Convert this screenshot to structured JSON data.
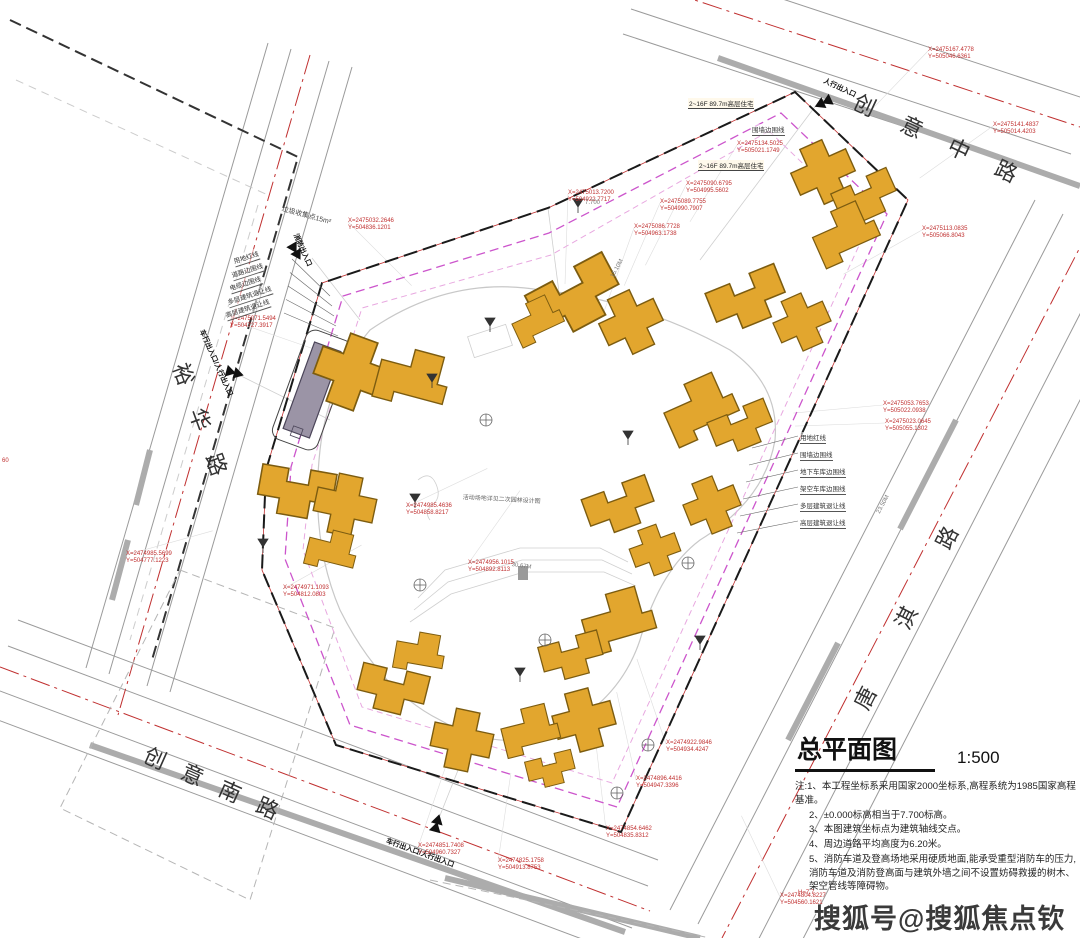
{
  "watermark": "搜狐号@搜狐焦点钦州站",
  "title_block": {
    "title": "总平面图",
    "scale": "1:500",
    "notes_label": "注:",
    "notes": [
      "1、本工程坐标系采用国家2000坐标系,高程系统为1985国家高程基准。",
      "2、±0.000标高相当于7.700标高。",
      "3、本图建筑坐标点为建筑轴线交点。",
      "4、周边道路平均高度为6.20米。",
      "5、消防车道及登高场地采用硬质地面,能承受重型消防车的压力,消防车道及消防登高面与建筑外墙之间不设置妨碍救援的树木、架空管线等障碍物。"
    ]
  },
  "roads": [
    {
      "name": "创意中路"
    },
    {
      "name": "裕华路"
    },
    {
      "name": "创意南路"
    },
    {
      "name": "唐淇路"
    }
  ],
  "entrances": [
    {
      "label": "人行出入口"
    },
    {
      "label": "消防出入口"
    },
    {
      "label": "车行出入口/人行出入口"
    },
    {
      "label": "车行出入口/人行出入口"
    }
  ],
  "callouts_left": [
    "用地红线",
    "道路边围线",
    "电缆边围线",
    "多层建筑退让线",
    "高层建筑退让线"
  ],
  "callouts_right": [
    "用地红线",
    "围墙边围线",
    "地下车库边围线",
    "架空车库边围线",
    "多层建筑退让线",
    "高层建筑退让线"
  ],
  "annotations": {
    "garbage_point": "垃圾收集点15m²",
    "highrise_tag": "2~16F 89.7m高层住宅",
    "fence_tag": "围墙边围线",
    "center_note": "活动场地详见二次园林设计图",
    "left_edge_mark": "60",
    "elev_mark": "H=7.7",
    "dim_labels": [
      "15.10M",
      "30.67M",
      "23.50M",
      "7.700"
    ]
  },
  "coordinates": [
    {
      "x": "X=2475032.2646",
      "y": "Y=504836.1201"
    },
    {
      "x": "X=2475013.7200",
      "y": "Y=504922.7717"
    },
    {
      "x": "X=2475086.7728",
      "y": "Y=504963.1738"
    },
    {
      "x": "X=2475089.7755",
      "y": "Y=504990.7907"
    },
    {
      "x": "X=2475090.6795",
      "y": "Y=504995.5602"
    },
    {
      "x": "X=2475134.5025",
      "y": "Y=505021.1749"
    },
    {
      "x": "X=2475167.4778",
      "y": "Y=505046.6361"
    },
    {
      "x": "X=2475141.4837",
      "y": "Y=505014.4203"
    },
    {
      "x": "X=2475113.0835",
      "y": "Y=505066.8043"
    },
    {
      "x": "X=2475053.7653",
      "y": "Y=505022.0938"
    },
    {
      "x": "X=2475023.0645",
      "y": "Y=505055.1302"
    },
    {
      "x": "X=2474985.5699",
      "y": "Y=504777.1223"
    },
    {
      "x": "X=2474971.1093",
      "y": "Y=504812.0803"
    },
    {
      "x": "X=2474922.9846",
      "y": "Y=504934.4247"
    },
    {
      "x": "X=2474896.4416",
      "y": "Y=504947.3396"
    },
    {
      "x": "X=2474854.6462",
      "y": "Y=504835.8312"
    },
    {
      "x": "X=2474851.7408",
      "y": "Y=504960.7327"
    },
    {
      "x": "X=2474825.1758",
      "y": "Y=504913.8753"
    },
    {
      "x": "X=2474804.8227",
      "y": "Y=504560.1621"
    },
    {
      "x": "X=2475071.5494",
      "y": "Y=504727.3917"
    },
    {
      "x": "X=2474985.4636",
      "y": "Y=504858.8217"
    },
    {
      "x": "X=2474956.1015",
      "y": "Y=504892.8113"
    }
  ],
  "colors": {
    "building_fill": "#E2A62E",
    "building_stroke": "#7C5C10",
    "boundary": "#1a1a1a",
    "red_line": "#C03030",
    "setback_magenta": "#CC55CC",
    "setback_pink": "#E8A8E0",
    "road_gray": "#9A9A9A",
    "curb_gray": "#ACACAC",
    "substation_fill": "#9B94A6"
  }
}
